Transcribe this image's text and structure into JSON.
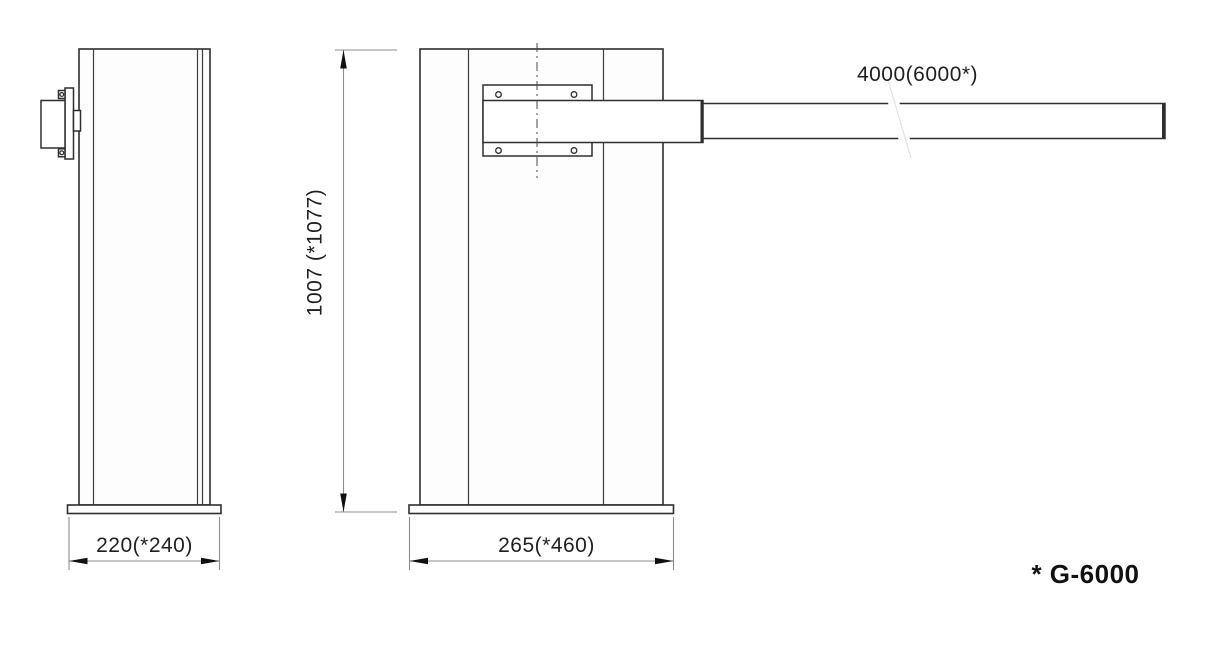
{
  "title": "* G-6000",
  "views": {
    "side": {
      "description": "side view of barrier gate cabinet",
      "width_label": "220(*240)"
    },
    "front": {
      "description": "front view of barrier gate cabinet with boom arm",
      "width_label": "265(*460)",
      "height_label": "1007 (*1077)"
    },
    "arm": {
      "length_label": "4000(6000*)"
    }
  },
  "colors": {
    "background": "#ffffff",
    "outline": "#2f2f2f",
    "inner_line": "#3c3c3c",
    "dimension": "#8c8c8c",
    "arrow": "#111111",
    "label": "#1f1f1f"
  }
}
